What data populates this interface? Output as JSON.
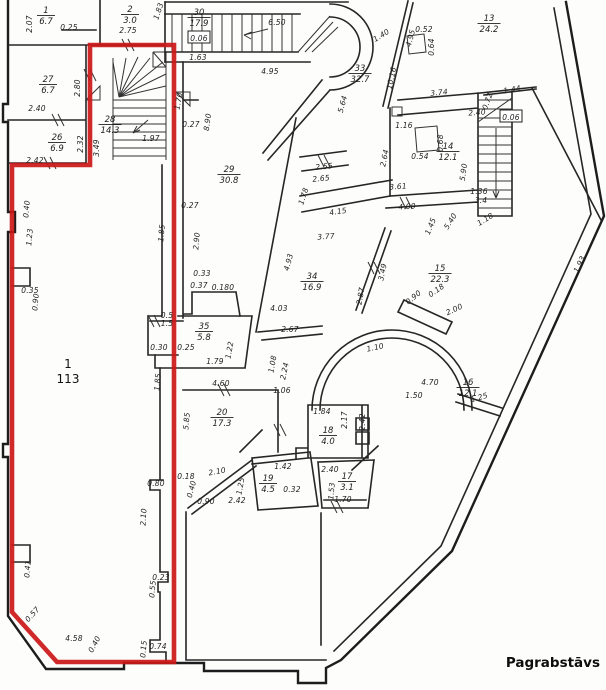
{
  "title": "Pagrabstāvs",
  "colors": {
    "outline": "#cc1717",
    "wall": "#262626",
    "background": "#fdfdfc"
  },
  "highlighted_room": {
    "id": "1",
    "area": "113"
  },
  "footer": {
    "label": "Pagrabstāvs"
  },
  "rooms": [
    {
      "id": "1",
      "area": "113",
      "x": 68,
      "y": 368,
      "plain": true
    },
    {
      "id": "1",
      "area": "6.7",
      "x": 46,
      "y": 13
    },
    {
      "id": "2",
      "area": "3.0",
      "x": 130,
      "y": 12
    },
    {
      "id": "27",
      "area": "6.7",
      "x": 48,
      "y": 82
    },
    {
      "id": "26",
      "area": "6.9",
      "x": 57,
      "y": 140
    },
    {
      "id": "30",
      "area": "17.9",
      "x": 199,
      "y": 15
    },
    {
      "id": "28",
      "area": "14.3",
      "x": 110,
      "y": 122
    },
    {
      "id": "29",
      "area": "30.8",
      "x": 229,
      "y": 172
    },
    {
      "id": "13",
      "area": "24.2",
      "x": 489,
      "y": 21
    },
    {
      "id": "33",
      "area": "32.7",
      "x": 360,
      "y": 71
    },
    {
      "id": "14",
      "area": "12.1",
      "x": 448,
      "y": 149
    },
    {
      "id": "34",
      "area": "16.9",
      "x": 312,
      "y": 279
    },
    {
      "id": "15",
      "area": "22.3",
      "x": 440,
      "y": 271
    },
    {
      "id": "35",
      "area": "5.8",
      "x": 204,
      "y": 329
    },
    {
      "id": "16",
      "area": "12.1",
      "x": 468,
      "y": 385
    },
    {
      "id": "20",
      "area": "17.3",
      "x": 222,
      "y": 415
    },
    {
      "id": "18",
      "area": "4.0",
      "x": 328,
      "y": 433
    },
    {
      "id": "19",
      "area": "4.5",
      "x": 268,
      "y": 481
    },
    {
      "id": "17",
      "area": "3.1",
      "x": 347,
      "y": 479
    }
  ],
  "dimensions": [
    {
      "t": "2.07",
      "x": 29,
      "y": 24,
      "r": -90
    },
    {
      "t": "0.25",
      "x": 69,
      "y": 27,
      "r": 0
    },
    {
      "t": "1.83",
      "x": 158,
      "y": 11,
      "r": -72
    },
    {
      "t": "2.75",
      "x": 128,
      "y": 30,
      "r": 0
    },
    {
      "t": "2.80",
      "x": 77,
      "y": 88,
      "r": -90
    },
    {
      "t": "2.40",
      "x": 37,
      "y": 108,
      "r": 0
    },
    {
      "t": "2.32",
      "x": 80,
      "y": 144,
      "r": -90
    },
    {
      "t": "2.42",
      "x": 35,
      "y": 160,
      "r": 0
    },
    {
      "t": "3.49",
      "x": 96,
      "y": 148,
      "r": -90
    },
    {
      "t": "0.06",
      "x": 199,
      "y": 38,
      "r": 0,
      "box": true
    },
    {
      "t": "1.63",
      "x": 198,
      "y": 57,
      "r": 0
    },
    {
      "t": "6.50",
      "x": 277,
      "y": 22,
      "r": 0
    },
    {
      "t": "4.95",
      "x": 270,
      "y": 71,
      "r": 0
    },
    {
      "t": "1.70",
      "x": 178,
      "y": 101,
      "r": -80
    },
    {
      "t": "0.27",
      "x": 191,
      "y": 124,
      "r": 0
    },
    {
      "t": "8.90",
      "x": 207,
      "y": 122,
      "r": -82
    },
    {
      "t": "1.97",
      "x": 151,
      "y": 138,
      "r": 0
    },
    {
      "t": "1.40",
      "x": 381,
      "y": 35,
      "r": -32
    },
    {
      "t": "4.95",
      "x": 410,
      "y": 38,
      "r": -75
    },
    {
      "t": "10.16",
      "x": 391,
      "y": 78,
      "r": -78
    },
    {
      "t": "5.64",
      "x": 342,
      "y": 104,
      "r": -75
    },
    {
      "t": "0.52",
      "x": 424,
      "y": 29,
      "r": 0
    },
    {
      "t": "0.64",
      "x": 431,
      "y": 47,
      "r": -90
    },
    {
      "t": "3.74",
      "x": 439,
      "y": 92,
      "r": -6
    },
    {
      "t": "1.44",
      "x": 512,
      "y": 89,
      "r": -10
    },
    {
      "t": "0.72",
      "x": 487,
      "y": 101,
      "r": -70
    },
    {
      "t": "0.06",
      "x": 511,
      "y": 117,
      "r": 0,
      "box": true
    },
    {
      "t": "1.16",
      "x": 404,
      "y": 125,
      "r": 0
    },
    {
      "t": "2.40",
      "x": 477,
      "y": 112,
      "r": -4
    },
    {
      "t": "0.54",
      "x": 420,
      "y": 156,
      "r": 0
    },
    {
      "t": "0.68",
      "x": 440,
      "y": 143,
      "r": -90
    },
    {
      "t": "5.90",
      "x": 463,
      "y": 172,
      "r": -82
    },
    {
      "t": "2.64",
      "x": 384,
      "y": 158,
      "r": -78
    },
    {
      "t": "3.61",
      "x": 398,
      "y": 186,
      "r": -4
    },
    {
      "t": "4.00",
      "x": 407,
      "y": 206,
      "r": -4
    },
    {
      "t": "1.45",
      "x": 430,
      "y": 226,
      "r": -68
    },
    {
      "t": "1.36",
      "x": 479,
      "y": 191,
      "r": 0
    },
    {
      "t": "3.4",
      "x": 481,
      "y": 200,
      "r": 0
    },
    {
      "t": "1.18",
      "x": 485,
      "y": 219,
      "r": -32
    },
    {
      "t": "5.40",
      "x": 450,
      "y": 221,
      "r": -58
    },
    {
      "t": "2.55",
      "x": 324,
      "y": 166,
      "r": -6
    },
    {
      "t": "2.65",
      "x": 321,
      "y": 178,
      "r": -6
    },
    {
      "t": "1.78",
      "x": 303,
      "y": 196,
      "r": -72
    },
    {
      "t": "4.15",
      "x": 338,
      "y": 211,
      "r": -8
    },
    {
      "t": "3.77",
      "x": 326,
      "y": 236,
      "r": -4
    },
    {
      "t": "1.93",
      "x": 579,
      "y": 264,
      "r": -65
    },
    {
      "t": "2.87",
      "x": 360,
      "y": 296,
      "r": -80
    },
    {
      "t": "3.49",
      "x": 382,
      "y": 272,
      "r": -78
    },
    {
      "t": "4.93",
      "x": 288,
      "y": 262,
      "r": -75
    },
    {
      "t": "0.27",
      "x": 190,
      "y": 205,
      "r": 0
    },
    {
      "t": "2.90",
      "x": 196,
      "y": 241,
      "r": -85
    },
    {
      "t": "0.33",
      "x": 202,
      "y": 273,
      "r": 0
    },
    {
      "t": "0.37",
      "x": 199,
      "y": 285,
      "r": 0
    },
    {
      "t": "0.180",
      "x": 223,
      "y": 287,
      "r": 0
    },
    {
      "t": "4.03",
      "x": 279,
      "y": 308,
      "r": 0
    },
    {
      "t": "2.67",
      "x": 290,
      "y": 329,
      "r": 0
    },
    {
      "t": "0.90",
      "x": 413,
      "y": 297,
      "r": -40
    },
    {
      "t": "0.18",
      "x": 436,
      "y": 290,
      "r": -35
    },
    {
      "t": "2.00",
      "x": 454,
      "y": 309,
      "r": -25
    },
    {
      "t": "0.5",
      "x": 167,
      "y": 315,
      "r": 0
    },
    {
      "t": "1.5",
      "x": 167,
      "y": 323,
      "r": 0
    },
    {
      "t": "0.30",
      "x": 159,
      "y": 347,
      "r": 0
    },
    {
      "t": "0.25",
      "x": 186,
      "y": 347,
      "r": 0
    },
    {
      "t": "1.22",
      "x": 229,
      "y": 350,
      "r": -80
    },
    {
      "t": "1.79",
      "x": 215,
      "y": 361,
      "r": 0
    },
    {
      "t": "1.10",
      "x": 375,
      "y": 347,
      "r": -12
    },
    {
      "t": "1.08",
      "x": 272,
      "y": 364,
      "r": -80
    },
    {
      "t": "2.24",
      "x": 284,
      "y": 371,
      "r": -78
    },
    {
      "t": "4.60",
      "x": 221,
      "y": 383,
      "r": 0
    },
    {
      "t": "1.06",
      "x": 282,
      "y": 390,
      "r": 0
    },
    {
      "t": "1.85",
      "x": 157,
      "y": 382,
      "r": -85
    },
    {
      "t": "5.85",
      "x": 186,
      "y": 421,
      "r": -85
    },
    {
      "t": "4.70",
      "x": 430,
      "y": 382,
      "r": 0
    },
    {
      "t": "1.50",
      "x": 414,
      "y": 395,
      "r": 0
    },
    {
      "t": "1.25",
      "x": 479,
      "y": 397,
      "r": -16
    },
    {
      "t": "1.84",
      "x": 322,
      "y": 411,
      "r": 0
    },
    {
      "t": "2.17",
      "x": 344,
      "y": 420,
      "r": -90
    },
    {
      "t": "2.42",
      "x": 362,
      "y": 422,
      "r": -90
    },
    {
      "t": "2.40",
      "x": 330,
      "y": 469,
      "r": 0
    },
    {
      "t": "1.53",
      "x": 331,
      "y": 491,
      "r": -85
    },
    {
      "t": "1.70",
      "x": 343,
      "y": 499,
      "r": 0
    },
    {
      "t": "1.42",
      "x": 283,
      "y": 466,
      "r": 0
    },
    {
      "t": "2.10",
      "x": 217,
      "y": 471,
      "r": -10
    },
    {
      "t": "1.25",
      "x": 240,
      "y": 486,
      "r": -80
    },
    {
      "t": "0.32",
      "x": 292,
      "y": 489,
      "r": 0
    },
    {
      "t": "0.18",
      "x": 186,
      "y": 476,
      "r": 0
    },
    {
      "t": "0.40",
      "x": 191,
      "y": 489,
      "r": -75
    },
    {
      "t": "0.90",
      "x": 206,
      "y": 501,
      "r": 0
    },
    {
      "t": "2.42",
      "x": 237,
      "y": 500,
      "r": 0
    },
    {
      "t": "0.40",
      "x": 26,
      "y": 209,
      "r": -85
    },
    {
      "t": "1.23",
      "x": 29,
      "y": 237,
      "r": -85
    },
    {
      "t": "1.85",
      "x": 161,
      "y": 233,
      "r": -85
    },
    {
      "t": "0.35",
      "x": 30,
      "y": 290,
      "r": 0
    },
    {
      "t": "0.90",
      "x": 35,
      "y": 302,
      "r": -85
    },
    {
      "t": "0.41",
      "x": 27,
      "y": 569,
      "r": -85
    },
    {
      "t": "0.57",
      "x": 32,
      "y": 614,
      "r": -48
    },
    {
      "t": "4.58",
      "x": 74,
      "y": 638,
      "r": 0
    },
    {
      "t": "0.40",
      "x": 94,
      "y": 644,
      "r": -62
    },
    {
      "t": "0.15",
      "x": 143,
      "y": 649,
      "r": -85
    },
    {
      "t": "0.74",
      "x": 158,
      "y": 646,
      "r": 0
    },
    {
      "t": "0.80",
      "x": 156,
      "y": 483,
      "r": 0
    },
    {
      "t": "2.10",
      "x": 143,
      "y": 517,
      "r": -87
    },
    {
      "t": "0.23",
      "x": 161,
      "y": 577,
      "r": 0
    },
    {
      "t": "0.55",
      "x": 152,
      "y": 589,
      "r": -85
    }
  ]
}
